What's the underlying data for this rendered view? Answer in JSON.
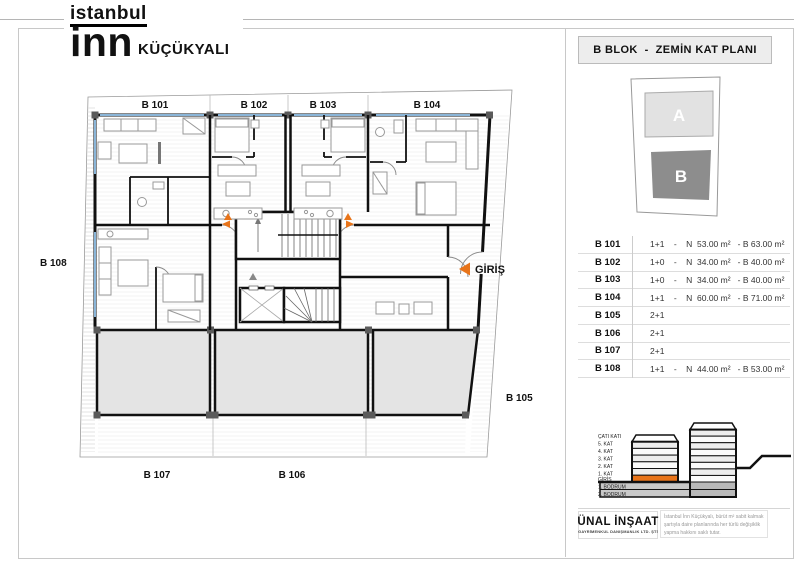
{
  "brand": {
    "line1": "istanbul",
    "line2": "inn",
    "location": "KÜÇÜKYALI"
  },
  "sidebar": {
    "title": "B BLOK  -  ZEMİN KAT PLANI",
    "site": {
      "block_a": "A",
      "block_b": "B"
    },
    "units": [
      {
        "id": "B 101",
        "details": "1+1    -    N  53.00 m²   - B 63.00 m²"
      },
      {
        "id": "B 102",
        "details": "1+0    -    N  34.00 m²   - B 40.00 m²"
      },
      {
        "id": "B 103",
        "details": "1+0    -    N  34.00 m²   - B 40.00 m²"
      },
      {
        "id": "B 104",
        "details": "1+1    -    N  60.00 m²   - B 71.00 m²"
      },
      {
        "id": "B 105",
        "details": "2+1"
      },
      {
        "id": "B 106",
        "details": "2+1"
      },
      {
        "id": "B 107",
        "details": "2+1"
      },
      {
        "id": "B 108",
        "details": "1+1    -    N  44.00 m²   - B 53.00 m²"
      }
    ],
    "section": {
      "floors": [
        "ÇATI KATI",
        "5. KAT",
        "4. KAT",
        "3. KAT",
        "2. KAT",
        "1. KAT",
        "GİRİŞ",
        "1. BODRUM",
        "2. BODRUM"
      ]
    },
    "footer": {
      "company": "ÜNAL İNŞAAT",
      "company_sub": "GAYRİMENKUL DANIŞMANLIK LTD. ŞTİ",
      "disclaimer_lines": [
        "İstanbul İnn Küçükyalı, bürüt m² sabit kalmak",
        "şartıyla daire planlarında her türlü değişiklik",
        "yapma hakkını saklı tutar."
      ]
    }
  },
  "plan": {
    "labels": {
      "b101": "B 101",
      "b102": "B 102",
      "b103": "B 103",
      "b104": "B 104",
      "b105": "B 105",
      "b106": "B 106",
      "b107": "B 107",
      "b108": "B 108"
    },
    "entrance": "GİRİŞ"
  },
  "colors": {
    "accent_orange": "#e8741a",
    "wall_black": "#111111",
    "window_blue": "#8ab5d8",
    "terrace_gray": "#e4e4e4",
    "block_a_gray": "#e2e2e2",
    "block_b_gray": "#8d8d8d"
  }
}
